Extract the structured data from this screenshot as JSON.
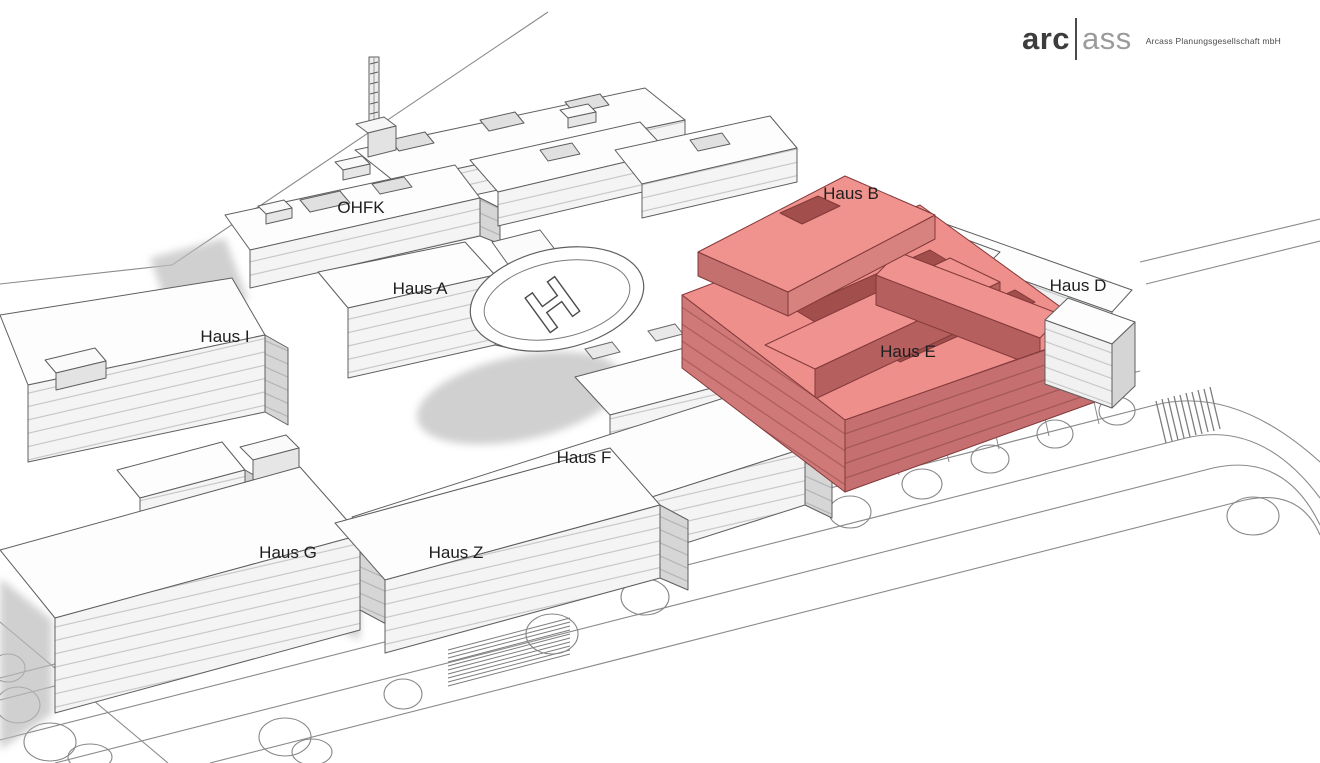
{
  "logo": {
    "part1": "arc",
    "part2": "ass",
    "tagline": "Arcass Planungsgesellschaft mbH"
  },
  "labels": {
    "ohfk": "OHFK",
    "haus_a": "Haus A",
    "haus_b": "Haus B",
    "haus_d": "Haus D",
    "haus_e": "Haus E",
    "haus_f": "Haus F",
    "haus_g": "Haus G",
    "haus_i": "Haus I",
    "haus_z": "Haus Z"
  },
  "helipad": {
    "letter": "H"
  },
  "colors": {
    "highlight_roof": "#f0908c",
    "highlight_front": "#cf7a78",
    "highlight_dark": "#a14e4c",
    "building_white": "#fdfdfd",
    "shadow_gray": "#bcbcbc",
    "outline": "#5f5f5f"
  }
}
